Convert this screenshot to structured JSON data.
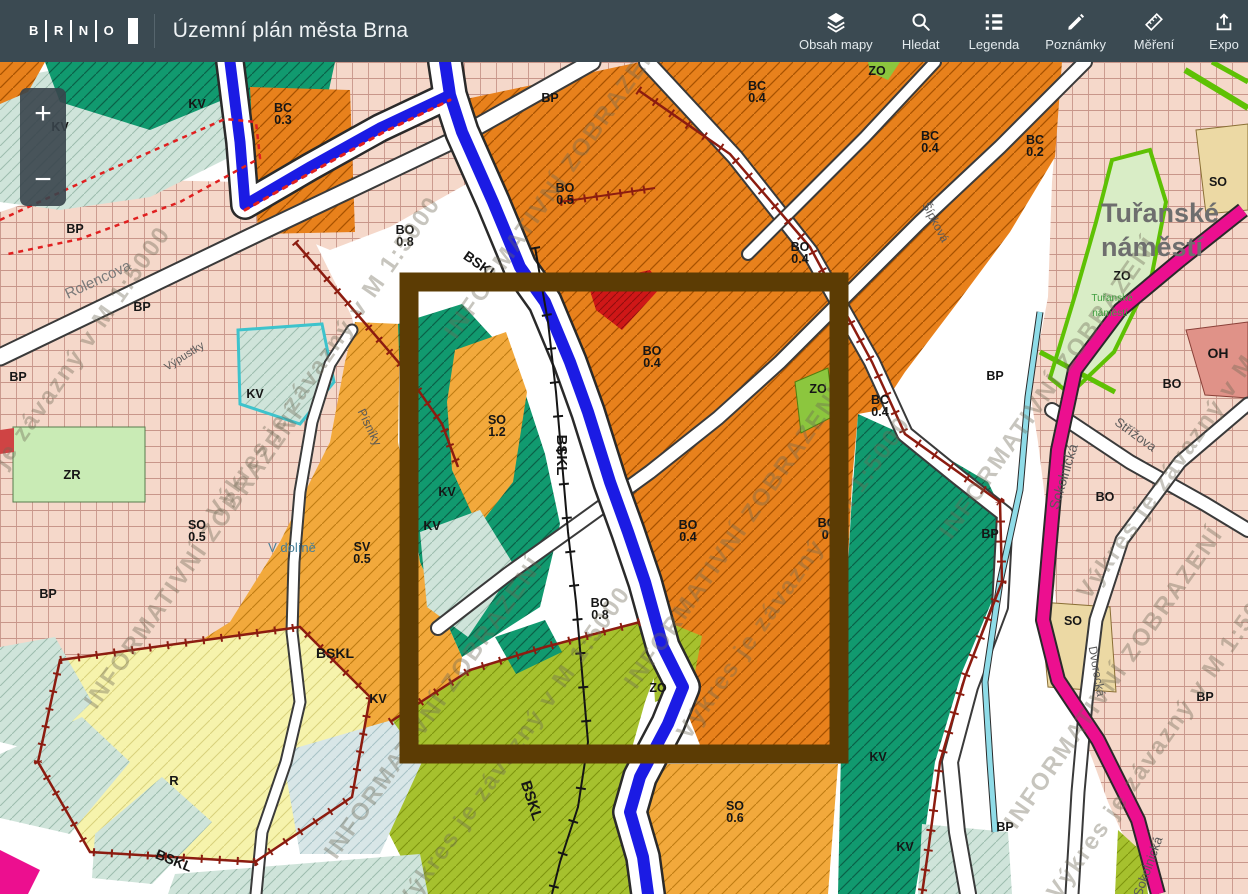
{
  "header": {
    "logo_letters": [
      "B",
      "R",
      "N",
      "O"
    ],
    "title": "Územní plán města Brna",
    "tools": [
      {
        "label": "Obsah mapy",
        "icon": "layers-icon"
      },
      {
        "label": "Hledat",
        "icon": "search-icon"
      },
      {
        "label": "Legenda",
        "icon": "legend-icon"
      },
      {
        "label": "Poznámky",
        "icon": "notes-icon"
      },
      {
        "label": "Měření",
        "icon": "ruler-icon"
      },
      {
        "label": "Expo",
        "icon": "export-icon"
      }
    ]
  },
  "zoom_control": {
    "zoom_in": "+",
    "zoom_out": "−"
  },
  "map": {
    "highlight_color": "#5c3c04",
    "colors": {
      "orange": "#e8811c",
      "amber": "#f2a93c",
      "pink": "#f5d8ca",
      "dark_green": "#119a6f",
      "mint": "#cfe4da",
      "olive": "#a6c12e",
      "yellow": "#f6f3ac",
      "red": "#cf1717",
      "magenta_road": "#ec0f8f",
      "river_blue": "#1b1be4",
      "boundary_red": "#8c1c10",
      "zo_green": "#d9edc6"
    },
    "zone_labels": [
      {
        "code": "BC",
        "value": "0.3",
        "x": 283,
        "y": 50
      },
      {
        "code": "BP",
        "x": 550,
        "y": 40
      },
      {
        "code": "BC",
        "value": "0.4",
        "x": 757,
        "y": 28
      },
      {
        "code": "BC",
        "value": "0.4",
        "x": 930,
        "y": 78
      },
      {
        "code": "BC",
        "value": "0.2",
        "x": 1035,
        "y": 82
      },
      {
        "code": "BO",
        "value": "0.5",
        "x": 565,
        "y": 130
      },
      {
        "code": "BO",
        "value": "0.8",
        "x": 405,
        "y": 172
      },
      {
        "code": "BO",
        "value": "0.4",
        "x": 800,
        "y": 189
      },
      {
        "code": "BO",
        "value": "0.4",
        "x": 652,
        "y": 293
      },
      {
        "code": "BO",
        "value": "0.4",
        "x": 688,
        "y": 467
      },
      {
        "code": "BO",
        "value": "0.",
        "x": 827,
        "y": 465
      },
      {
        "code": "BO",
        "value": "0.8",
        "x": 600,
        "y": 545
      },
      {
        "code": "BC",
        "value": "0.4",
        "x": 880,
        "y": 342
      },
      {
        "code": "SO",
        "value": "1.2",
        "x": 497,
        "y": 362
      },
      {
        "code": "SO",
        "value": "0.5",
        "x": 197,
        "y": 467
      },
      {
        "code": "SV",
        "value": "0.5",
        "x": 362,
        "y": 489
      },
      {
        "code": "SO",
        "value": "0.6",
        "x": 735,
        "y": 748
      },
      {
        "code": "SO",
        "x": 1073,
        "y": 563
      },
      {
        "code": "SO",
        "x": 1218,
        "y": 124
      },
      {
        "code": "OH",
        "x": 1218,
        "y": 296,
        "size": 14
      },
      {
        "code": "ZR",
        "x": 72,
        "y": 417,
        "size": 13
      },
      {
        "code": "R",
        "x": 174,
        "y": 723,
        "size": 13
      },
      {
        "code": "ZO",
        "x": 818,
        "y": 331
      },
      {
        "code": "ZO",
        "x": 877,
        "y": 13
      },
      {
        "code": "ZO",
        "x": 658,
        "y": 630
      },
      {
        "code": "ZO",
        "x": 1122,
        "y": 218
      },
      {
        "code": "BO",
        "x": 1172,
        "y": 326
      },
      {
        "code": "BO",
        "x": 1105,
        "y": 439
      },
      {
        "code": "BP",
        "x": 18,
        "y": 319
      },
      {
        "code": "BP",
        "x": 48,
        "y": 536
      },
      {
        "code": "BP",
        "x": 75,
        "y": 171
      },
      {
        "code": "BP",
        "x": 142,
        "y": 249
      },
      {
        "code": "BP",
        "x": 995,
        "y": 318
      },
      {
        "code": "BP",
        "x": 990,
        "y": 476
      },
      {
        "code": "BP",
        "x": 1205,
        "y": 639
      },
      {
        "code": "BP",
        "x": 1005,
        "y": 769
      },
      {
        "code": "KV",
        "x": 60,
        "y": 69
      },
      {
        "code": "KV",
        "x": 197,
        "y": 46
      },
      {
        "code": "KV",
        "x": 255,
        "y": 336
      },
      {
        "code": "KV",
        "x": 447,
        "y": 434
      },
      {
        "code": "KV",
        "x": 432,
        "y": 468
      },
      {
        "code": "KV",
        "x": 378,
        "y": 641
      },
      {
        "code": "KV",
        "x": 878,
        "y": 699
      },
      {
        "code": "KV",
        "x": 905,
        "y": 789
      },
      {
        "code": "BSKL",
        "x": 478,
        "y": 207,
        "rot": 35,
        "size": 14
      },
      {
        "code": "BSKL",
        "x": 557,
        "y": 393,
        "rot": 90,
        "size": 15
      },
      {
        "code": "BSKL",
        "x": 527,
        "y": 740,
        "rot": 72,
        "size": 15
      },
      {
        "code": "BSKL",
        "x": 335,
        "y": 596,
        "size": 14
      },
      {
        "code": "BSKL",
        "x": 172,
        "y": 803,
        "rot": 22,
        "size": 14
      }
    ],
    "street_labels": [
      {
        "text": "Rolencova",
        "x": 100,
        "y": 222,
        "rot": -25,
        "size": 15,
        "color": "#7a7a7a"
      },
      {
        "text": "Výpustky",
        "x": 186,
        "y": 297,
        "rot": -32,
        "size": 11
      },
      {
        "text": "Písníky",
        "x": 366,
        "y": 367,
        "rot": 64,
        "size": 12
      },
      {
        "text": "V dolíně",
        "x": 292,
        "y": 490,
        "size": 13,
        "color": "#48809a"
      },
      {
        "text": "Šípková",
        "x": 932,
        "y": 162,
        "rot": 62,
        "size": 12
      },
      {
        "text": "Sokolnická",
        "x": 1068,
        "y": 416,
        "rot": -73,
        "size": 14
      },
      {
        "text": "Sokolnická",
        "x": 1152,
        "y": 806,
        "rot": -70,
        "size": 13
      },
      {
        "text": "Střížova",
        "x": 1133,
        "y": 376,
        "rot": 36,
        "size": 13
      },
      {
        "text": "Dvorecká",
        "x": 1093,
        "y": 610,
        "rot": 80,
        "size": 12
      }
    ],
    "place_labels": [
      {
        "text": "Tuřanské",
        "x": 1160,
        "y": 160,
        "size": 27,
        "weight": 700,
        "color": "#6e6e6e"
      },
      {
        "text": "náměstí",
        "x": 1152,
        "y": 194,
        "size": 27,
        "weight": 700,
        "color": "#6e6e6e"
      },
      {
        "text": "Tuřanské",
        "x": 1112,
        "y": 239,
        "size": 10,
        "weight": 400,
        "color": "#3f9e3f"
      },
      {
        "text": "náměstí",
        "x": 1110,
        "y": 254,
        "size": 10,
        "weight": 400,
        "color": "#3f9e3f"
      }
    ],
    "watermarks": [
      {
        "text": "INFORMATIVNÍ ZOBRAZENÍ",
        "x": 560,
        "y": 130
      },
      {
        "text": "Výkres je závazný v M 1:5000",
        "x": 330,
        "y": 300
      },
      {
        "text": "INFORMATIVNÍ ZOBRAZENÍ",
        "x": 200,
        "y": 500
      },
      {
        "text": "Výkres je závazný v M 1:5000",
        "x": 60,
        "y": 330
      },
      {
        "text": "INFORMATIVNÍ ZOBRAZENÍ",
        "x": 440,
        "y": 650
      },
      {
        "text": "Výkres je závazný v M 1:5000",
        "x": 520,
        "y": 690
      },
      {
        "text": "INFORMATIVNÍ ZOBRAZENÍ",
        "x": 740,
        "y": 480
      },
      {
        "text": "Výkres je závazný v M 1:5000",
        "x": 800,
        "y": 520
      },
      {
        "text": "INFORMATIVNÍ ZOBRAZENÍ",
        "x": 1055,
        "y": 330
      },
      {
        "text": "Výkres je závazný v M 1:5000",
        "x": 1200,
        "y": 380
      },
      {
        "text": "INFORMATIVNÍ ZOBRAZENÍ",
        "x": 1120,
        "y": 620
      },
      {
        "text": "Výkres je závazný v M 1:5000",
        "x": 1170,
        "y": 680
      }
    ]
  }
}
